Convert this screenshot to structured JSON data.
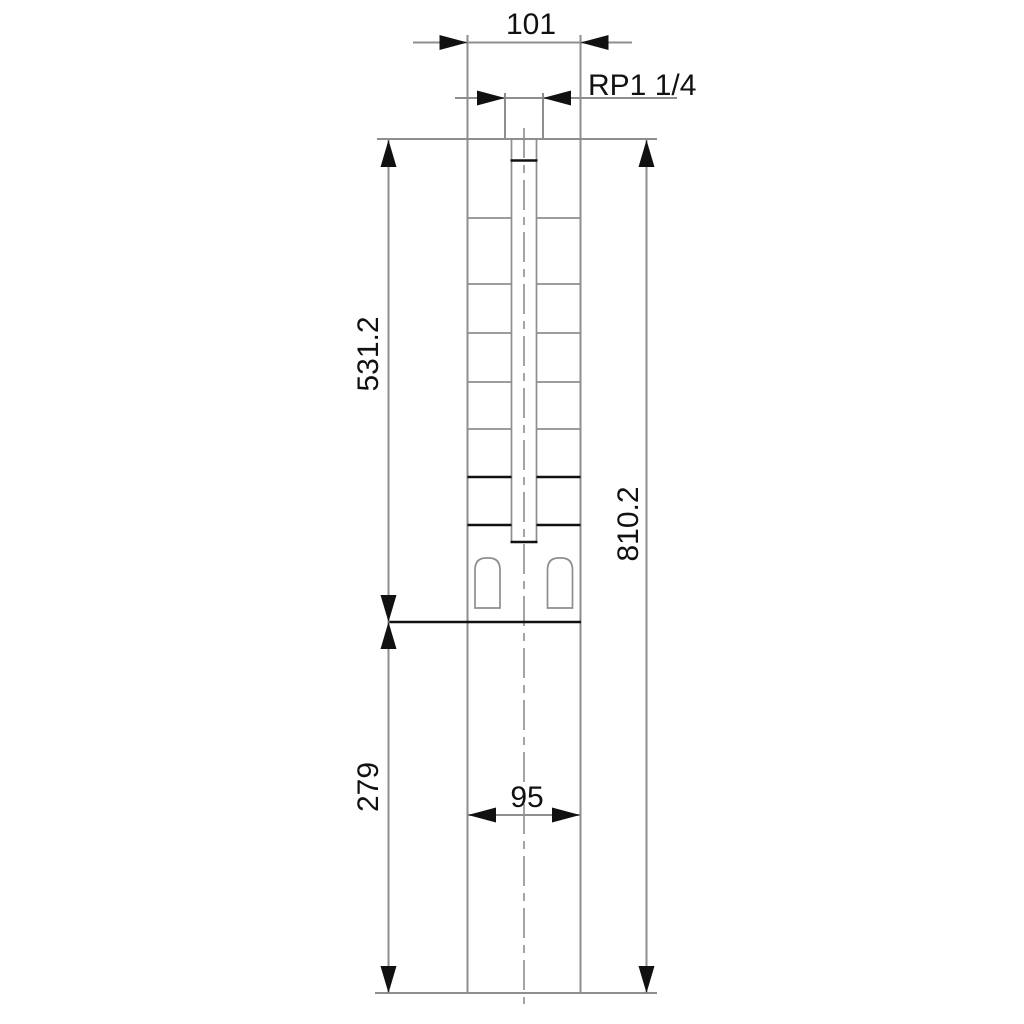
{
  "drawing": {
    "type": "technical dimensional drawing",
    "subject": "submersible borehole pump outline with dimensions (mm)",
    "labels": {
      "top_width": "101",
      "thread": "RP1 1/4",
      "pump_section_length": "531.2",
      "motor_section_length": "279",
      "total_length": "810.2",
      "motor_width": "95"
    },
    "colors": {
      "background": "#ffffff",
      "line_gray": "#8e8e8e",
      "line_black": "#111111"
    }
  }
}
